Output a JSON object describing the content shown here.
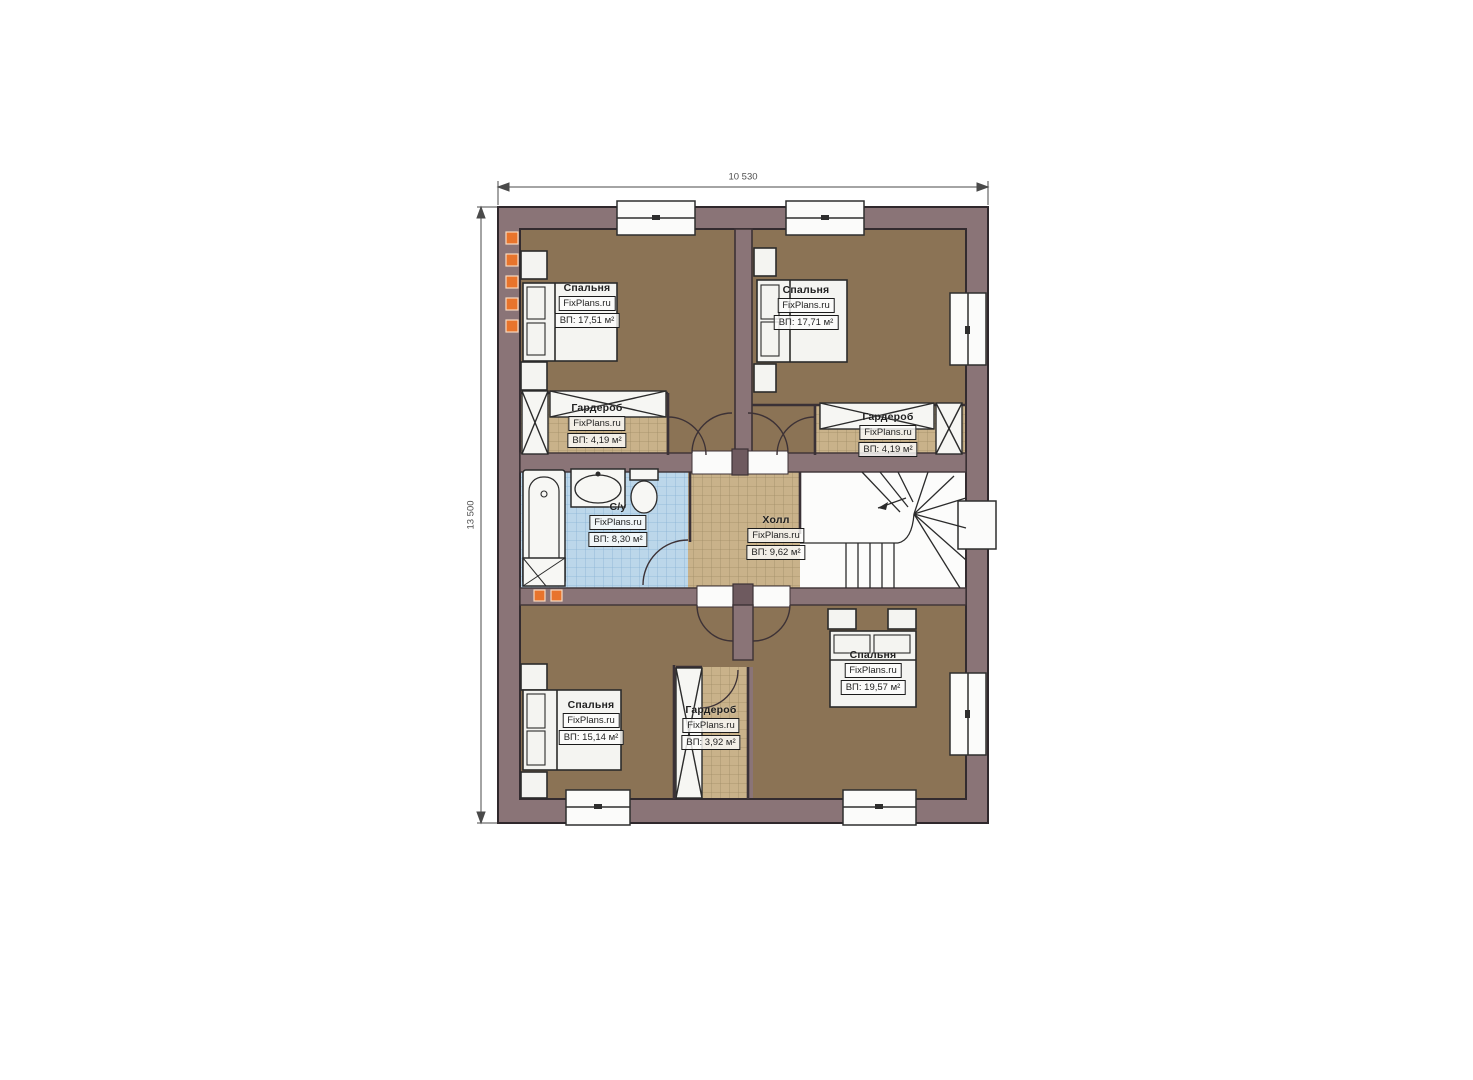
{
  "brand": "FixPlans.ru",
  "dimensions": {
    "top": "10 530",
    "left": "13 500"
  },
  "rooms": {
    "bedroom_tl": {
      "name": "Спальня",
      "area": "ВП: 17,51 м²"
    },
    "bedroom_tr": {
      "name": "Спальня",
      "area": "ВП: 17,71 м²"
    },
    "wardrobe_l": {
      "name": "Гардероб",
      "area": "ВП: 4,19 м²"
    },
    "wardrobe_r": {
      "name": "Гардероб",
      "area": "ВП: 4,19 м²"
    },
    "bathroom": {
      "name": "С/у",
      "area": "ВП: 8,30 м²"
    },
    "hall": {
      "name": "Холл",
      "area": "ВП: 9,62 м²"
    },
    "bedroom_bl": {
      "name": "Спальня",
      "area": "ВП: 15,14 м²"
    },
    "wardrobe_b": {
      "name": "Гардероб",
      "area": "ВП: 3,92 м²"
    },
    "bedroom_br": {
      "name": "Спальня",
      "area": "ВП: 19,57 м²"
    }
  },
  "colors": {
    "wall": "#8a7477",
    "wall_dark": "#6e5a5f",
    "outline": "#3d3236",
    "bedroom_floor": "#8b7355",
    "tile_tan": "#c9b28a",
    "tile_blue": "#bcd7ea",
    "accent_orange": "#e8742c"
  }
}
